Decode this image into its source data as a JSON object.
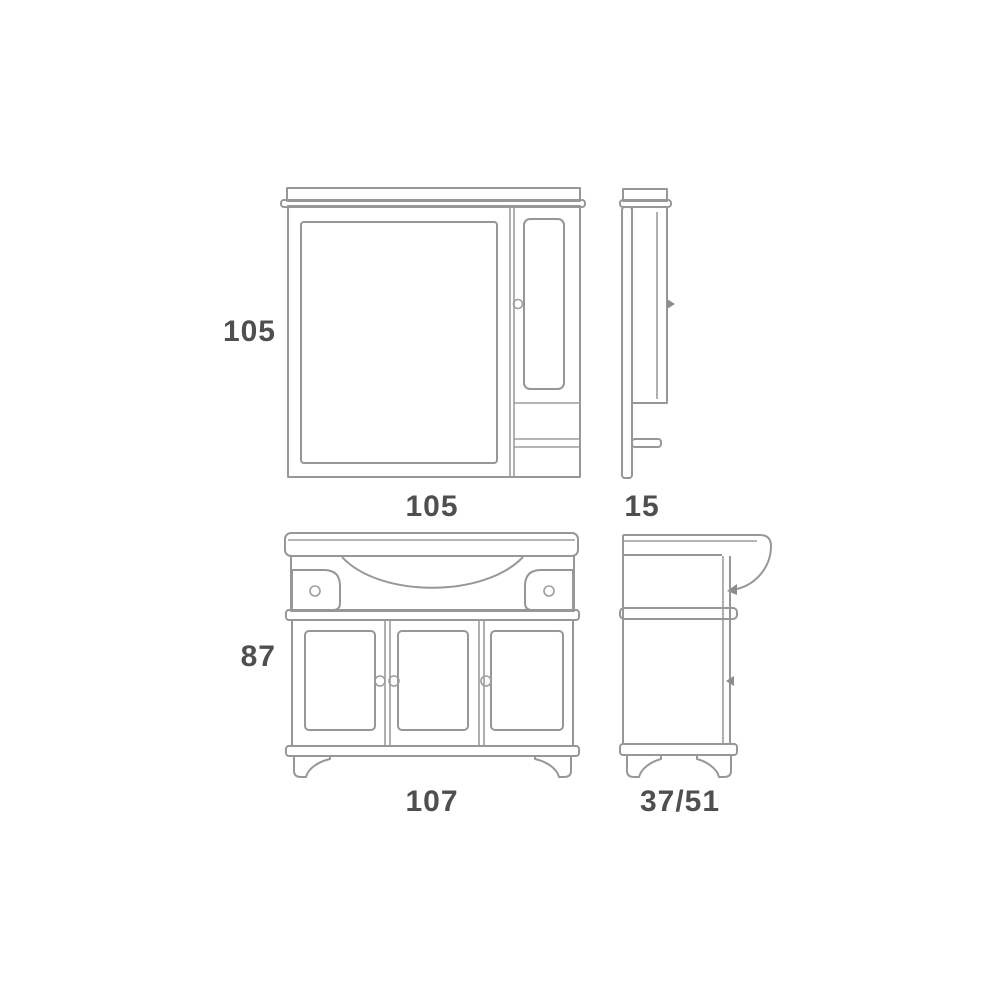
{
  "drawing": {
    "type": "furniture-technical-drawing",
    "subject": "bathroom vanity with mirror cabinet, four orthographic views",
    "background_color": "#ffffff",
    "line_color": "#979797",
    "label_color": "#4f4f4f",
    "views": {
      "mirror_front": {
        "height": "105",
        "width": "105"
      },
      "mirror_side": {
        "depth": "15"
      },
      "vanity_front": {
        "height": "87",
        "width": "107"
      },
      "vanity_side": {
        "depth": "37/51"
      }
    }
  }
}
